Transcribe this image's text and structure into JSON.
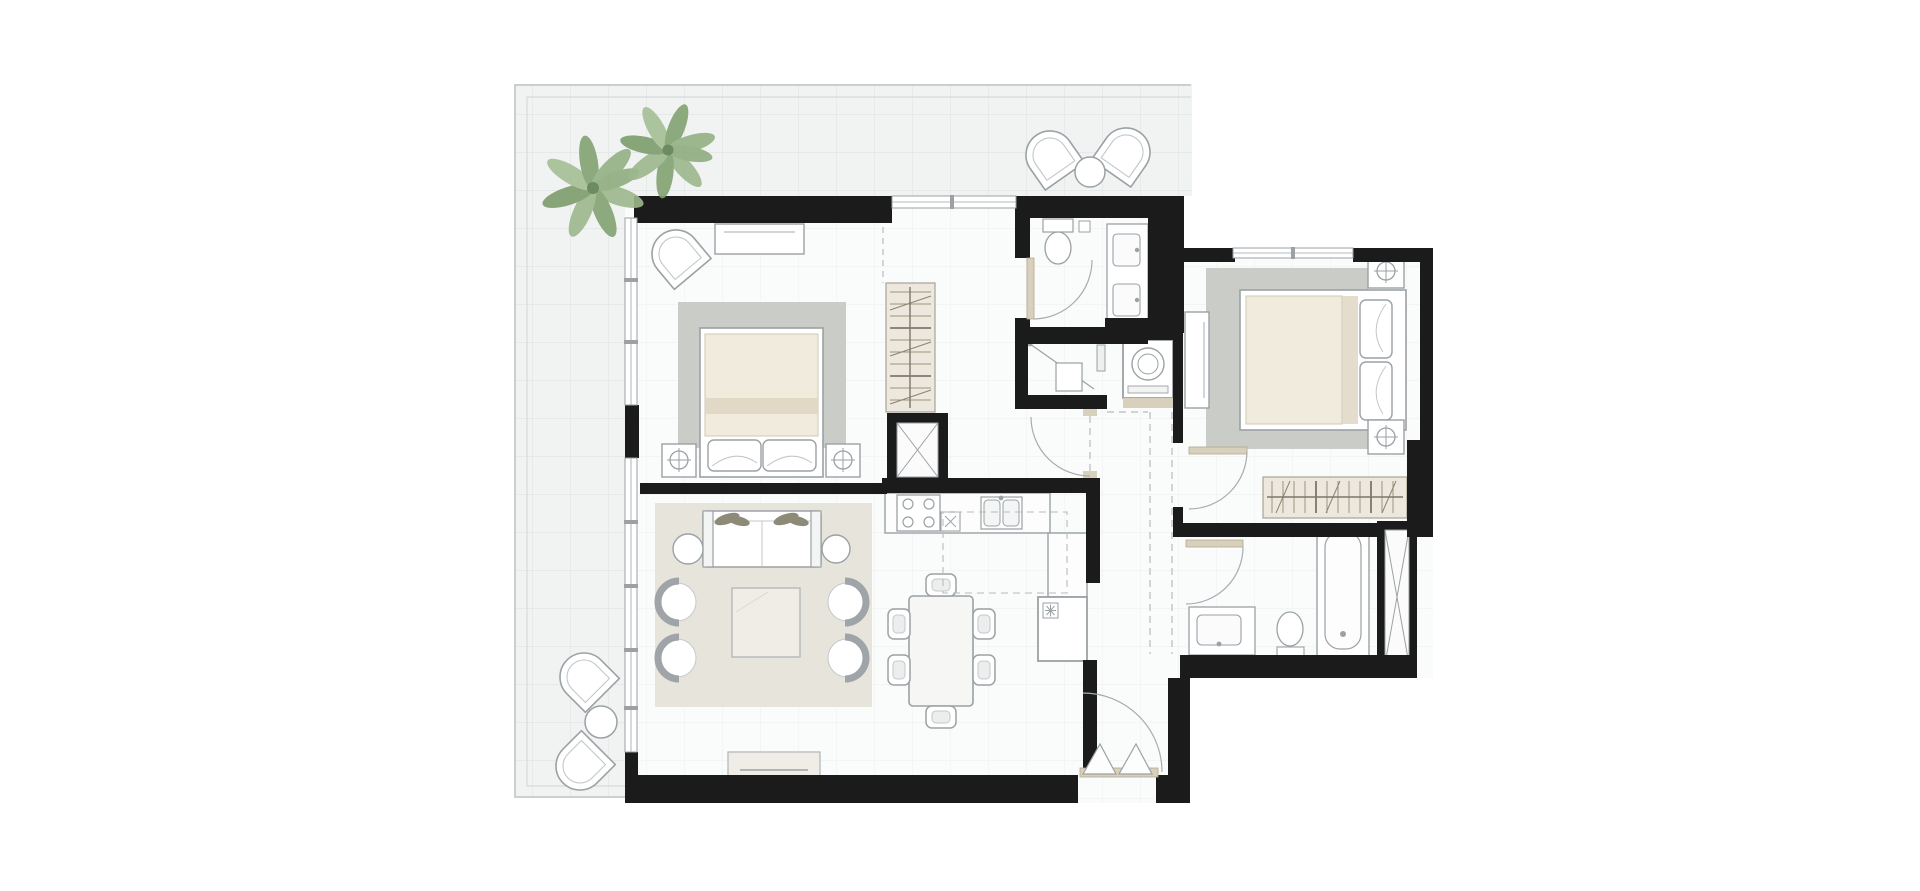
{
  "colors": {
    "wall": "#1b1b1b",
    "terrace_tile": "#f1f3f3",
    "tile_grid": "#e4e7e7",
    "floor": "#fafbfb",
    "floor_grid": "#eff1f1",
    "border": "#c7cacc",
    "rug_gray": "#c9ccc7",
    "rug_living": "#e7e4db",
    "furniture_stroke": "#9ba1a4",
    "furniture_fill": "#ffffff",
    "mattress": "#f0ebdd",
    "mattress_band": "#ddd5c0",
    "wood": "#d8cfbc",
    "wardrobe_fill": "#ece8dd",
    "wardrobe_line": "#978f7c",
    "wardrobe_rail": "#6f695c",
    "palm_light": "#9cb88c",
    "palm_dark": "#82a371",
    "palm_center": "#6d8b60",
    "dash": "#b7bbbd",
    "cushion_olive": "#8d8a77",
    "table_fill": "#efede6"
  },
  "plan": {
    "type": "residential apartment floor plan, top-down view, unlabeled",
    "style": "black walls, light tiled wrap-around terrace, grayscale furniture symbols",
    "counts": {
      "bedrooms": 2,
      "bathrooms": 2,
      "palm_trees": 2,
      "outdoor_lounge_chairs": 4,
      "living_armchairs": 4,
      "dining_chairs": 6,
      "service_shafts": 2
    },
    "rooms": [
      {
        "id": "terrace",
        "desc": "L-shaped tiled terrace wrapping top and left sides",
        "items": [
          "two palm trees",
          "two lounge chairs with round table (top)",
          "two lounge chairs with round table (bottom-left)"
        ]
      },
      {
        "id": "master-bedroom",
        "desc": "top-left bedroom with glazed left wall",
        "items": [
          "double bed with two pillows",
          "gray area rug",
          "two nightstands with lamps",
          "curved lounge chair",
          "console dresser"
        ]
      },
      {
        "id": "dressing-area",
        "desc": "corridor to ensuite",
        "items": [
          "open wardrobe with hanging rail",
          "crossed service shaft"
        ]
      },
      {
        "id": "ensuite-bathroom",
        "desc": "top-middle bathroom",
        "items": [
          "toilet",
          "double-sink vanity",
          "swing door"
        ]
      },
      {
        "id": "shower-room",
        "desc": "below ensuite",
        "items": [
          "walk-in shower with diagonal screen",
          "glass door"
        ]
      },
      {
        "id": "laundry-niche",
        "desc": "off hallway",
        "items": [
          "washing machine"
        ]
      },
      {
        "id": "hallway",
        "desc": "central corridor with dashed bulkhead lines",
        "items": []
      },
      {
        "id": "living-room",
        "desc": "lower-left lounge",
        "items": [
          "two-seat sofa with olive cushions",
          "four C-shaped armchairs",
          "square coffee table",
          "two round side tables",
          "beige area rug",
          "media console"
        ]
      },
      {
        "id": "dining-area",
        "desc": "right of lounge",
        "items": [
          "rectangular table",
          "six chairs"
        ]
      },
      {
        "id": "kitchen",
        "desc": "L-shaped counter",
        "items": [
          "four-burner cooktop",
          "double sink",
          "refrigerator",
          "dashed overhead cabinets"
        ]
      },
      {
        "id": "entry-vestibule",
        "desc": "bottom-right entry",
        "items": [
          "double entrance door with swing arc",
          "threshold"
        ]
      },
      {
        "id": "bedroom-2",
        "desc": "right wing bedroom",
        "items": [
          "double bed with two pillows",
          "gray area rug",
          "two nightstands with lamps",
          "tall cabinet",
          "built-in wardrobe with hanging rail"
        ]
      },
      {
        "id": "bathroom-2",
        "desc": "bottom of right wing",
        "items": [
          "bathtub",
          "vanity sink",
          "toilet",
          "crossed service shaft"
        ]
      }
    ]
  }
}
